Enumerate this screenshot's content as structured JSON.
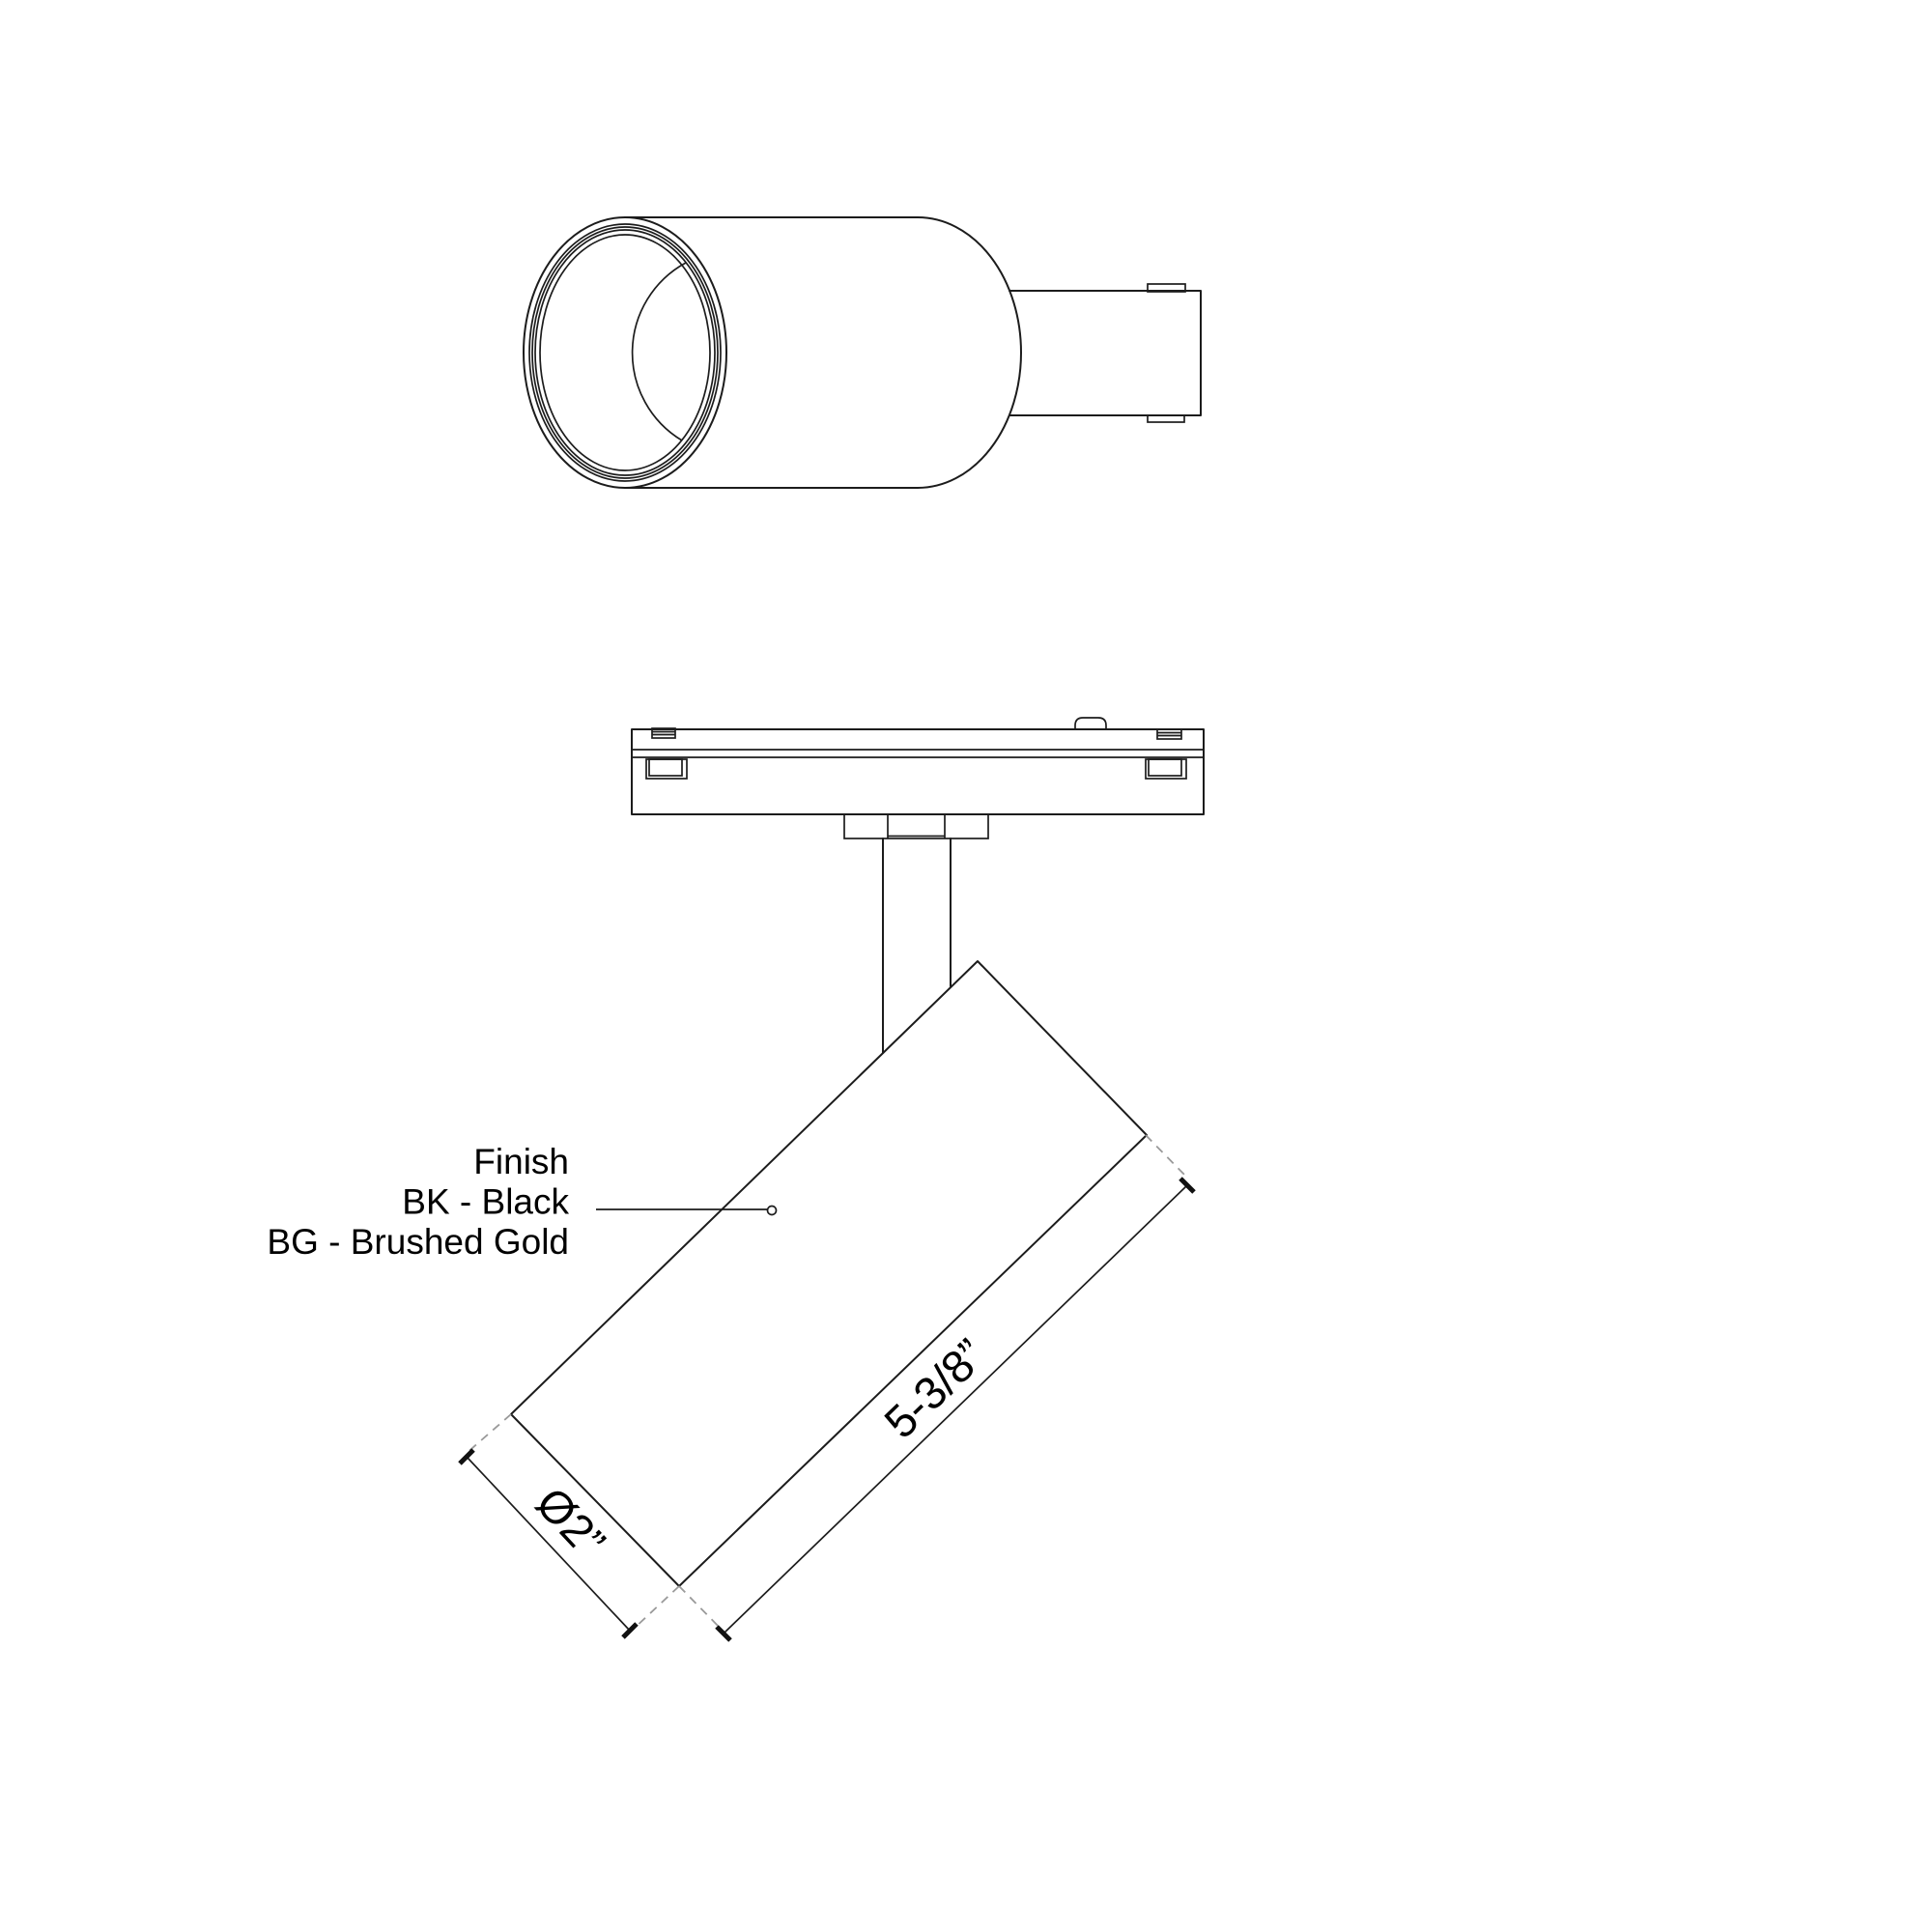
{
  "finish": {
    "title": "Finish",
    "bk": "BK - Black",
    "bg": "BG - Brushed Gold"
  },
  "dimensions": {
    "length": "5-3/8”",
    "diameter": "Ø2”"
  },
  "colors": {
    "line": "#1c1c1c",
    "dashed_extension": "#9a9a9a",
    "text": "#000000",
    "background": "#ffffff"
  }
}
